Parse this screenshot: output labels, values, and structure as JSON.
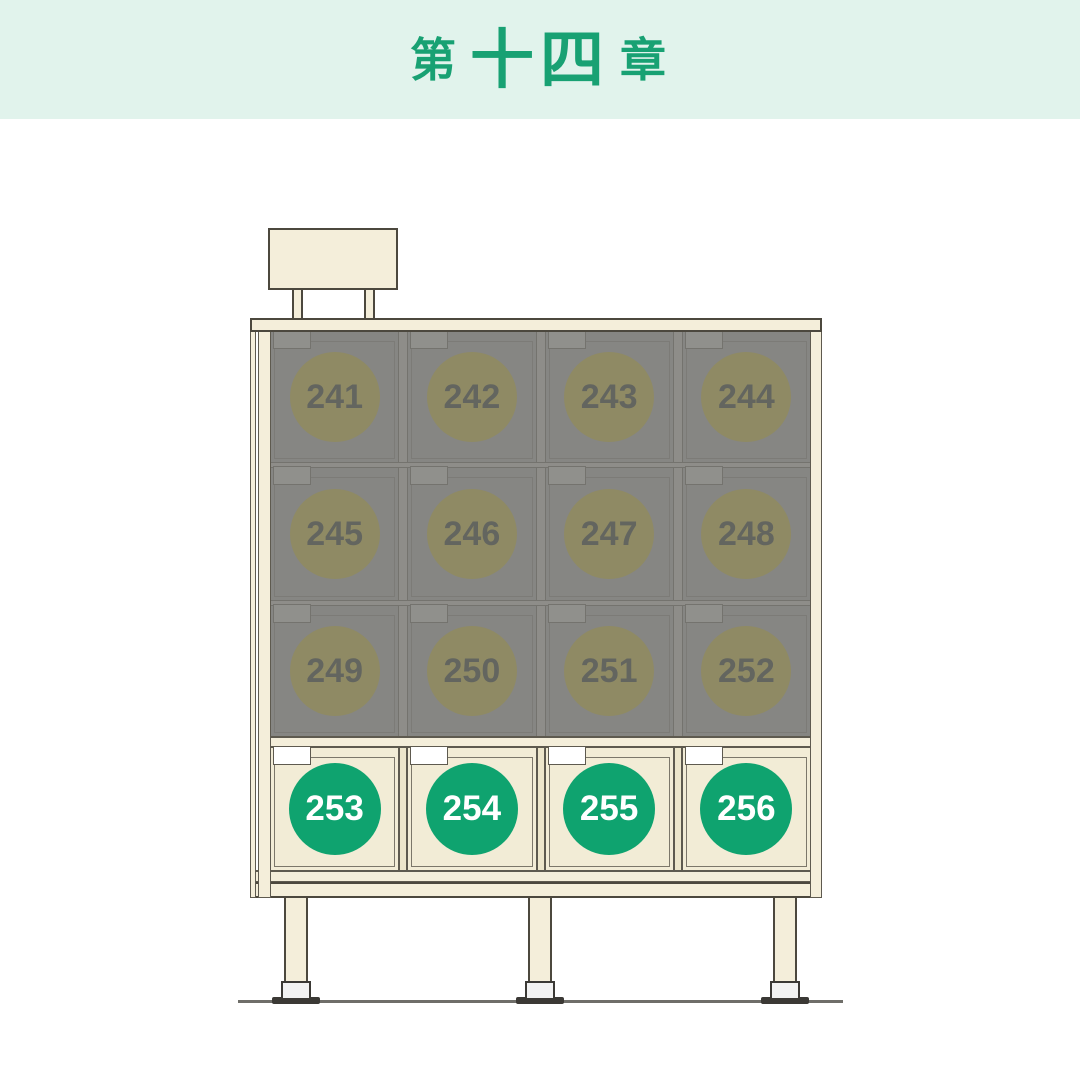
{
  "header": {
    "prefix": "第",
    "number": "十四",
    "suffix": "章"
  },
  "colors": {
    "header-bg": "#E1F3EC",
    "header-green": "#18A173",
    "cream": "#F4EEDA",
    "cream-cell": "#F2ECD6",
    "cream-dark": "#EDE6CB",
    "outline": "#4C483E",
    "outline-soft": "#5E5A4F",
    "dim-bg": "#868683",
    "dim-line": "#74736E",
    "dim-rail": "#8E8D89",
    "dim-tab": "#90908C",
    "dim-circle": "#8F8A64",
    "dim-num": "#63655F",
    "green": "#0FA36F",
    "white": "#FFFFFF",
    "ground": "#6F6E69",
    "foot": "#F2F2F2",
    "plate": "#3B3935"
  },
  "cabinet": {
    "rows": [
      {
        "dimmed": true,
        "cells": [
          {
            "number": "241"
          },
          {
            "number": "242"
          },
          {
            "number": "243"
          },
          {
            "number": "244"
          }
        ]
      },
      {
        "dimmed": true,
        "cells": [
          {
            "number": "245"
          },
          {
            "number": "246"
          },
          {
            "number": "247"
          },
          {
            "number": "248"
          }
        ]
      },
      {
        "dimmed": true,
        "cells": [
          {
            "number": "249"
          },
          {
            "number": "250"
          },
          {
            "number": "251"
          },
          {
            "number": "252"
          }
        ]
      },
      {
        "dimmed": false,
        "cells": [
          {
            "number": "253"
          },
          {
            "number": "254"
          },
          {
            "number": "255"
          },
          {
            "number": "256"
          }
        ]
      }
    ]
  }
}
